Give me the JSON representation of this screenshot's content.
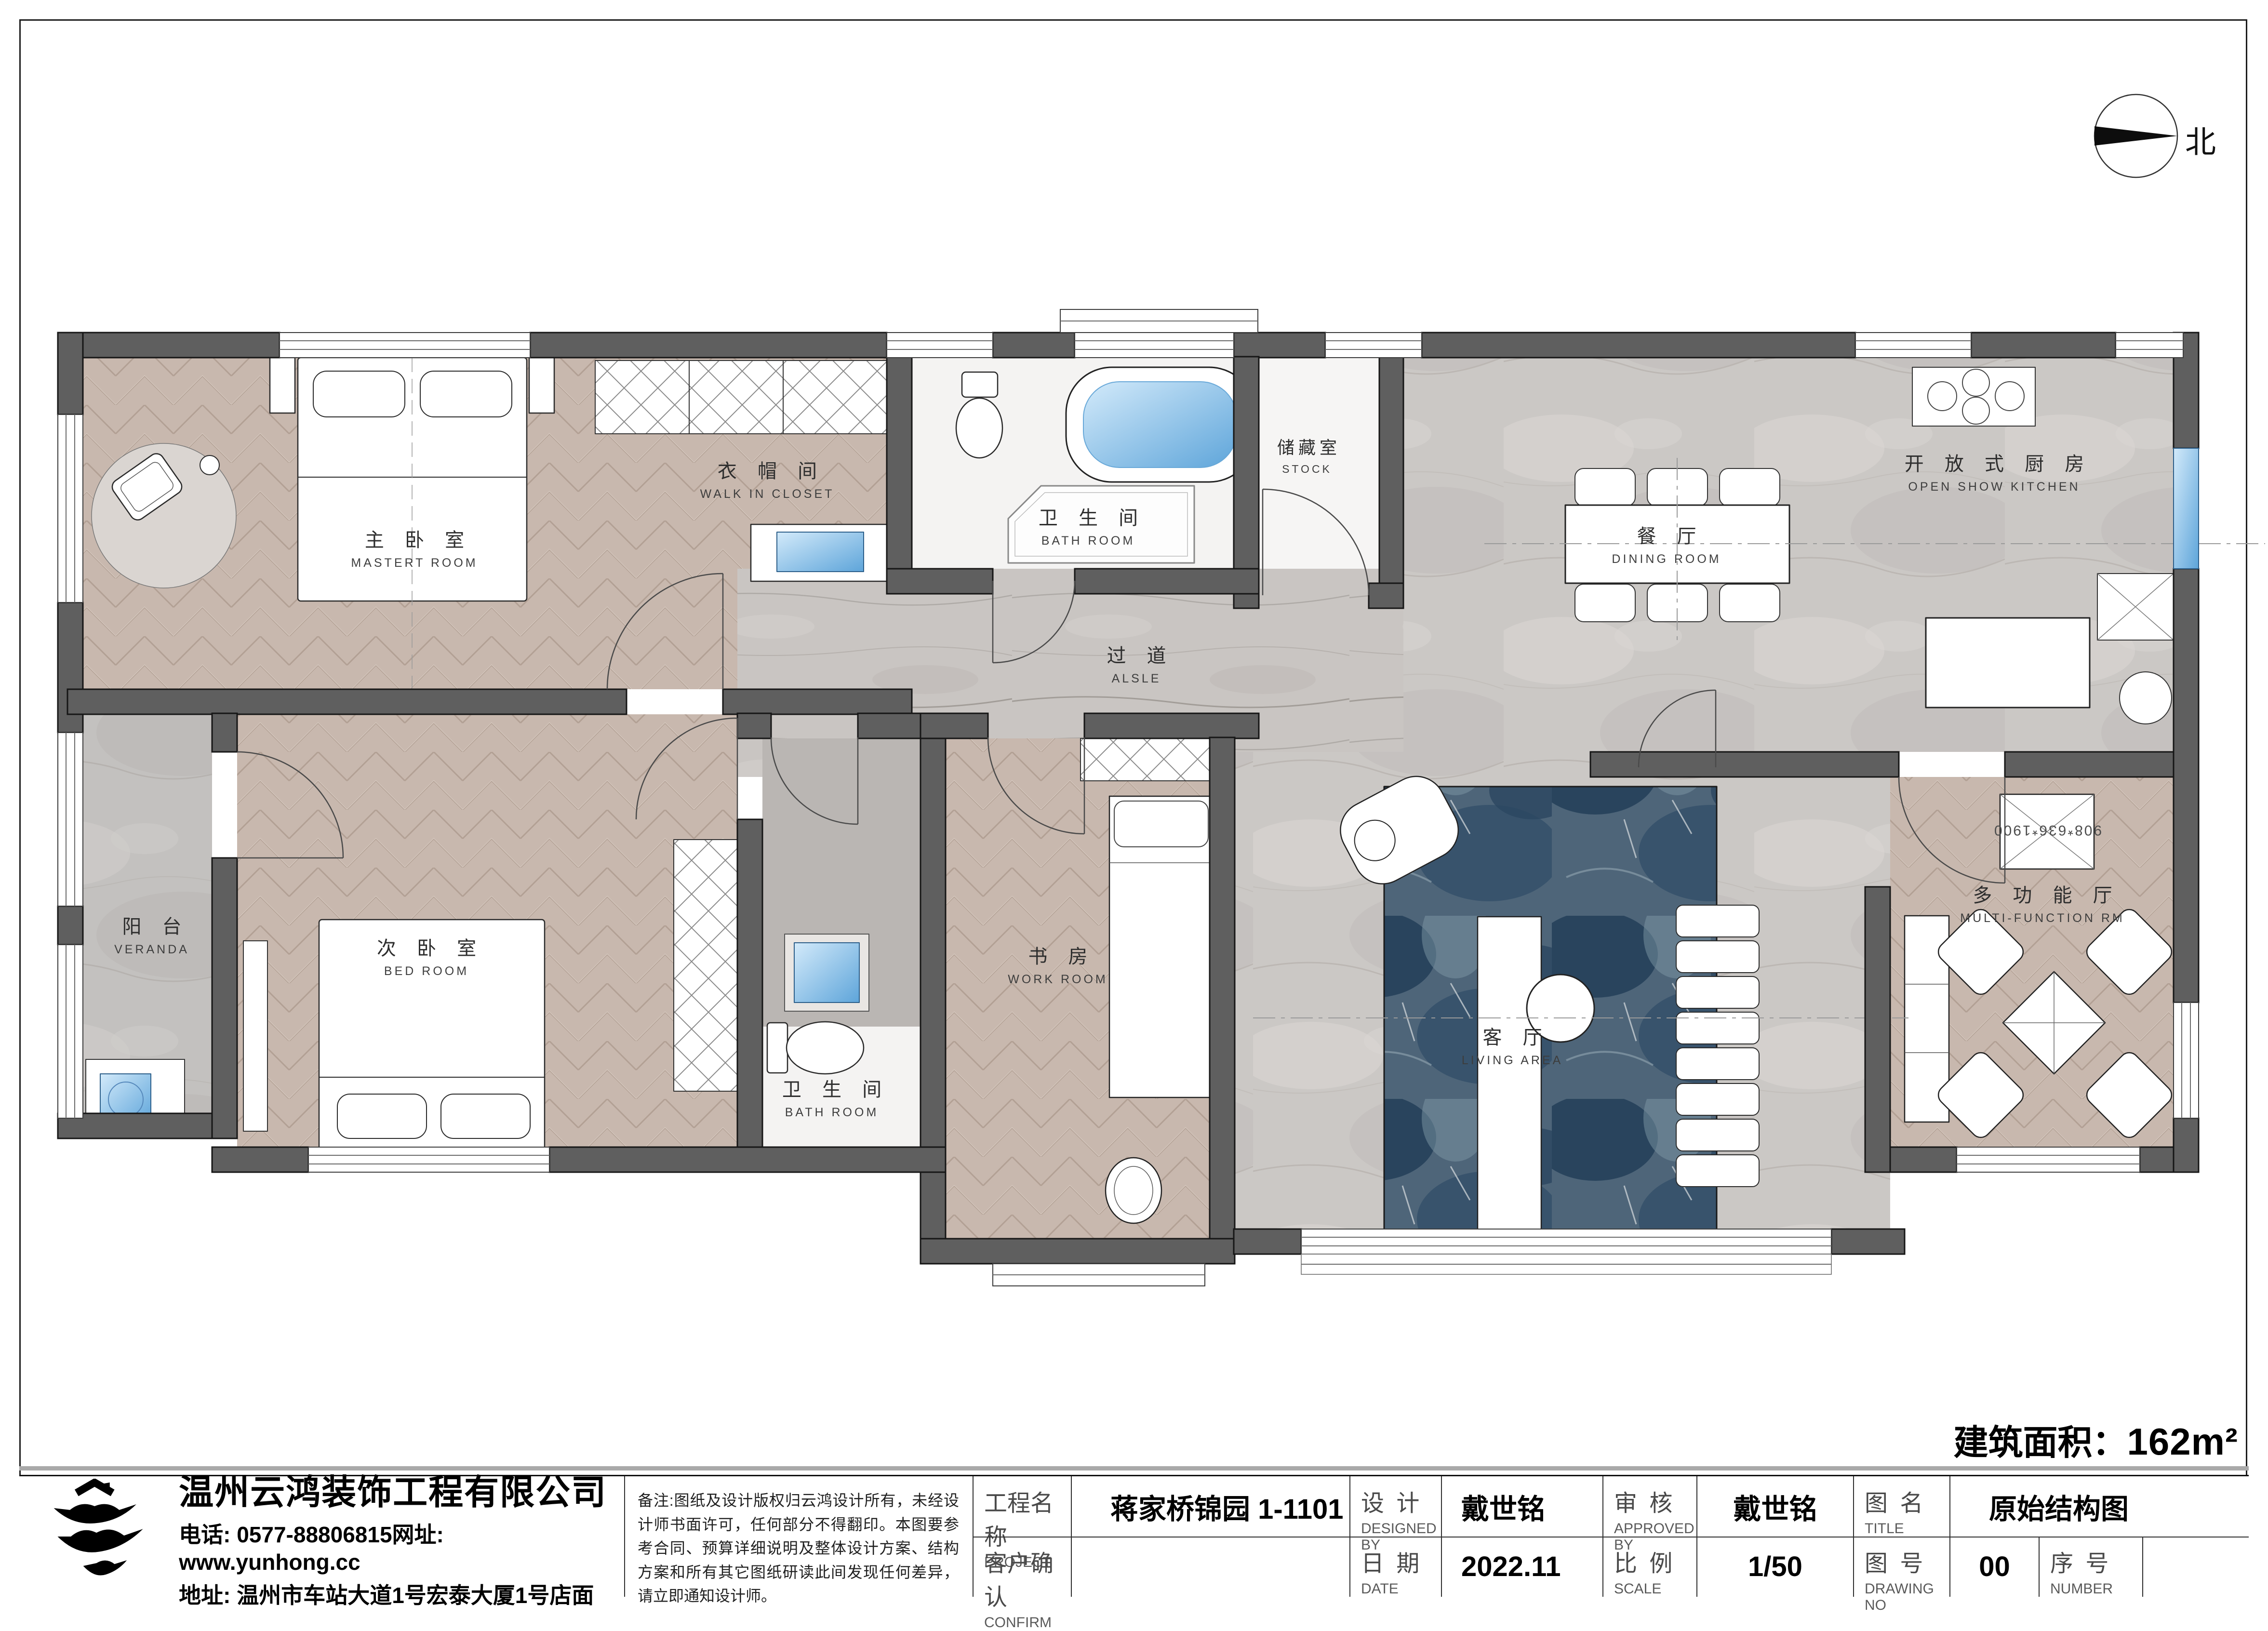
{
  "sheet": {
    "north_label": "北",
    "area_label": "建筑面积：",
    "area_value": "162m²"
  },
  "rooms": [
    {
      "id": "master-bedroom",
      "cn": "主 卧 室",
      "en": "MASTERT ROOM"
    },
    {
      "id": "walk-in-closet",
      "cn": "衣 帽 间",
      "en": "WALK IN CLOSET"
    },
    {
      "id": "bathroom-top",
      "cn": "卫 生 间",
      "en": "BATH ROOM"
    },
    {
      "id": "stock",
      "cn": "储藏室",
      "en": "STOCK"
    },
    {
      "id": "dining-room",
      "cn": "餐 厅",
      "en": "DINING ROOM"
    },
    {
      "id": "open-kitchen",
      "cn": "开 放 式 厨 房",
      "en": "OPEN SHOW KITCHEN"
    },
    {
      "id": "aisle",
      "cn": "过 道",
      "en": "ALSLE"
    },
    {
      "id": "veranda",
      "cn": "阳 台",
      "en": "VERANDA"
    },
    {
      "id": "second-bedroom",
      "cn": "次 卧 室",
      "en": "BED ROOM"
    },
    {
      "id": "bathroom-bottom",
      "cn": "卫 生 间",
      "en": "BATH ROOM"
    },
    {
      "id": "work-room",
      "cn": "书 房",
      "en": "WORK ROOM"
    },
    {
      "id": "living-area",
      "cn": "客 厅",
      "en": "LIVING AREA"
    },
    {
      "id": "multi-function",
      "cn": "多 功 能 厅",
      "en": "MULTI-FUNCTION RM"
    }
  ],
  "annotations": {
    "cabinet_dim": "908*636*1900"
  },
  "company": {
    "name": "温州云鸿装饰工程有限公司",
    "phone": "电话: 0577-88806815网址: www.yunhong.cc",
    "address": "地址: 温州市车站大道1号宏泰大厦1号店面"
  },
  "notes": "备注:图纸及设计版权归云鸿设计所有，未经设计师书面许可，任何部分不得翻印。本图要参考合同、预算详细说明及整体设计方案、结构方案和所有其它图纸研读此间发现任何差异，请立即通知设计师。",
  "fields": {
    "project_label_cn": "工程名称",
    "project_label_en": "PROJECT",
    "project_value": "蒋家桥锦园 1-1101",
    "confirm_label_cn": "客户确认",
    "confirm_label_en": "CONFIRM",
    "confirm_value": "",
    "designed_label_cn": "设 计",
    "designed_label_en": "DESIGNED BY",
    "designed_value": "戴世铭",
    "date_label_cn": "日 期",
    "date_label_en": "DATE",
    "date_value": "2022.11",
    "approved_label_cn": "审 核",
    "approved_label_en": "APPROVED BY",
    "approved_value": "戴世铭",
    "scale_label_cn": "比 例",
    "scale_label_en": "SCALE",
    "scale_value": "1/50",
    "title_label_cn": "图 名",
    "title_label_en": "TITLE",
    "title_value": "原始结构图",
    "no_label_cn": "图 号",
    "no_label_en": "DRAWING NO",
    "no_value": "00",
    "number_label_cn": "序 号",
    "number_label_en": "NUMBER",
    "number_value": ""
  }
}
